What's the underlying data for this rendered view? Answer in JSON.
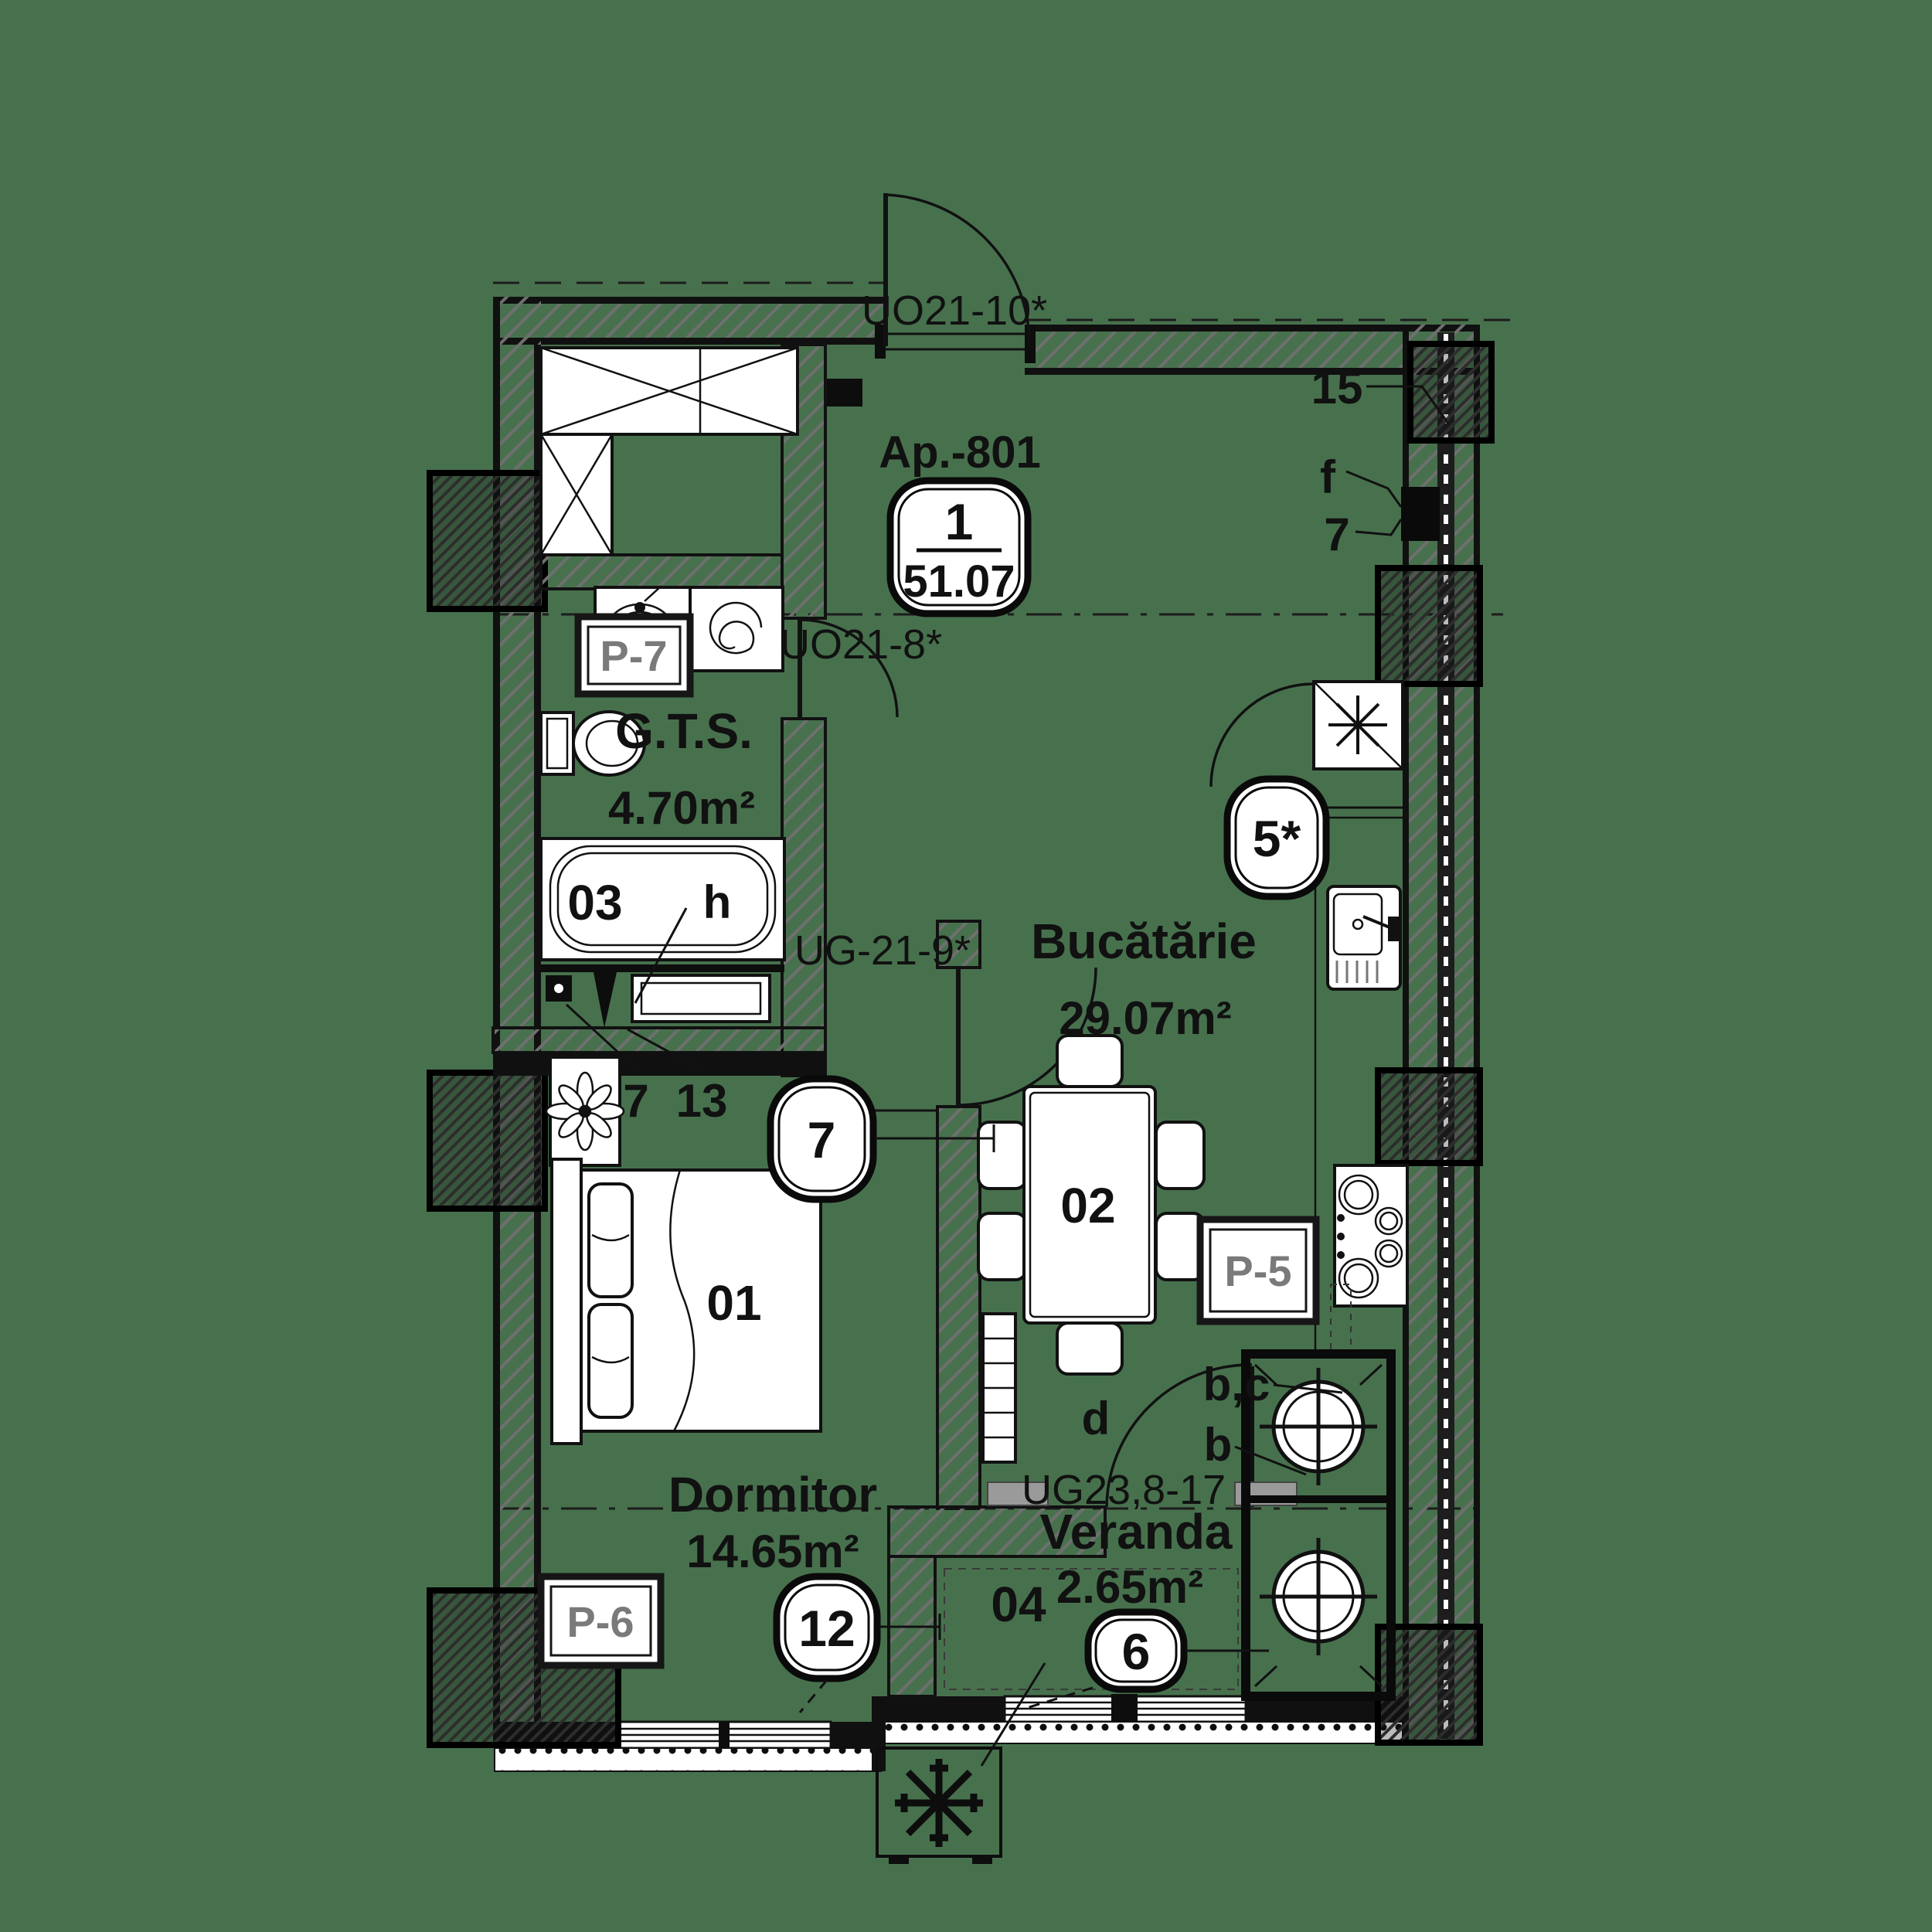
{
  "plan": {
    "title": "Ap.-801",
    "area_badge": {
      "numerator": "1",
      "denominator": "51.07"
    },
    "rooms": {
      "gts": {
        "name": "G.T.S.",
        "area": "4.70m²",
        "number": "03"
      },
      "kitchen": {
        "name": "Bucătărie",
        "area": "29.07m²",
        "number": "02"
      },
      "bedroom": {
        "name": "Dormitor",
        "area": "14.65m²",
        "number": "01"
      },
      "veranda": {
        "name": "Veranda",
        "area": "2.65m²",
        "number": "04"
      }
    },
    "doors": {
      "entry": "UO21-10*",
      "gts": "UO21-8*",
      "kitchen": "UG-21-9*",
      "veranda": "UG23,8-17"
    },
    "panels": {
      "p7": "P-7",
      "p5": "P-5",
      "p6": "P-6"
    },
    "badges": {
      "kitchen_vent": "5*",
      "bedroom_wall": "7",
      "bedroom_window": "12",
      "veranda_window": "6"
    },
    "marks": {
      "wall_15": "15",
      "wall_f": "f",
      "wall_7": "7",
      "fixture_7": "7",
      "fixture_13": "13",
      "tub_h": "h",
      "door_d": "d",
      "door_bc": "b,c",
      "door_b": "b"
    },
    "colors": {
      "background": "#47714d",
      "line": "#111111",
      "wall_hatch": "#6f6f6f",
      "panel_text": "#7a7a7a",
      "fill_white": "#ffffff"
    }
  }
}
